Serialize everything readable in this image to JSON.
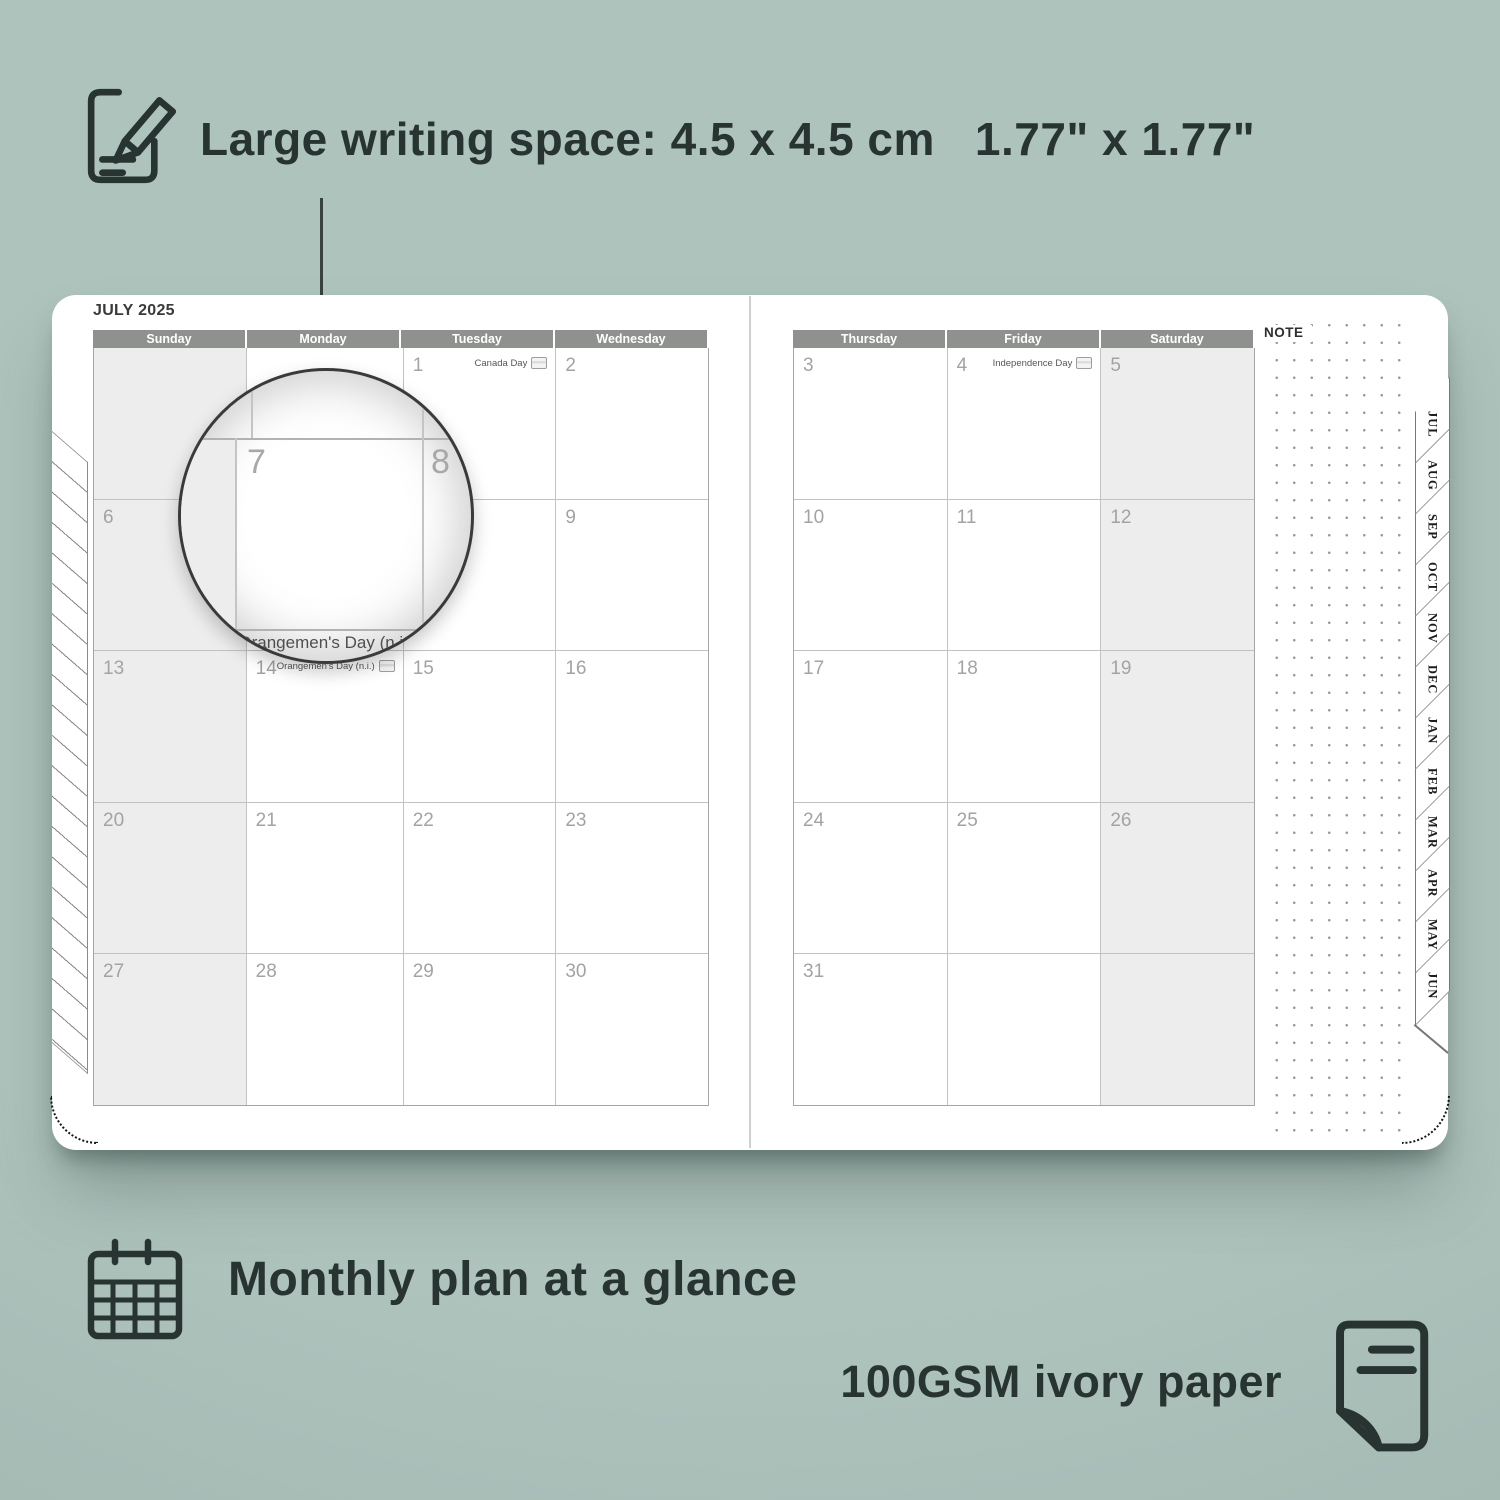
{
  "colors": {
    "background": "#aabfb8",
    "ink": "#273431",
    "page": "#ffffff",
    "header_bar": "#8e918e",
    "weekend_cell_shade": "#ededed",
    "grid_line": "#c2c2c2",
    "day_number": "#a3a3a3",
    "dot_grid": "#979c9a"
  },
  "annotation_top": {
    "text_metric": "Large writing space: 4.5 x 4.5 cm",
    "text_imperial": "1.77\" x 1.77\""
  },
  "captions": {
    "monthly": "Monthly plan at a glance",
    "paper": "100GSM ivory paper"
  },
  "planner": {
    "title": "JULY 2025",
    "note_label": "NOTE",
    "left_day_headers": [
      "Sunday",
      "Monday",
      "Tuesday",
      "Wednesday"
    ],
    "right_day_headers": [
      "Thursday",
      "Friday",
      "Saturday"
    ],
    "left_rows": [
      [
        {},
        {},
        {
          "num": "1",
          "holiday": "Canada Day"
        },
        {
          "num": "2"
        }
      ],
      [
        {
          "num": "6"
        },
        {
          "num": "7"
        },
        {
          "num": "8"
        },
        {
          "num": "9"
        }
      ],
      [
        {
          "num": "13"
        },
        {
          "num": "14",
          "holiday": "Orangemen's Day (n.i.)"
        },
        {
          "num": "15"
        },
        {
          "num": "16"
        }
      ],
      [
        {
          "num": "20"
        },
        {
          "num": "21"
        },
        {
          "num": "22"
        },
        {
          "num": "23"
        }
      ],
      [
        {
          "num": "27"
        },
        {
          "num": "28"
        },
        {
          "num": "29"
        },
        {
          "num": "30"
        }
      ]
    ],
    "right_rows": [
      [
        {
          "num": "3"
        },
        {
          "num": "4",
          "holiday": "Independence Day"
        },
        {
          "num": "5"
        }
      ],
      [
        {
          "num": "10"
        },
        {
          "num": "11"
        },
        {
          "num": "12"
        }
      ],
      [
        {
          "num": "17"
        },
        {
          "num": "18"
        },
        {
          "num": "19"
        }
      ],
      [
        {
          "num": "24"
        },
        {
          "num": "25"
        },
        {
          "num": "26"
        }
      ],
      [
        {
          "num": "31"
        },
        {},
        {}
      ]
    ],
    "month_tabs": [
      "JUL",
      "AUG",
      "SEP",
      "OCT",
      "NOV",
      "DEC",
      "JAN",
      "FEB",
      "MAR",
      "APR",
      "MAY",
      "JUN"
    ],
    "magnifier": {
      "day_left": "7",
      "day_right": "8",
      "holiday": "Orangemen's Day (n.i.)"
    }
  }
}
